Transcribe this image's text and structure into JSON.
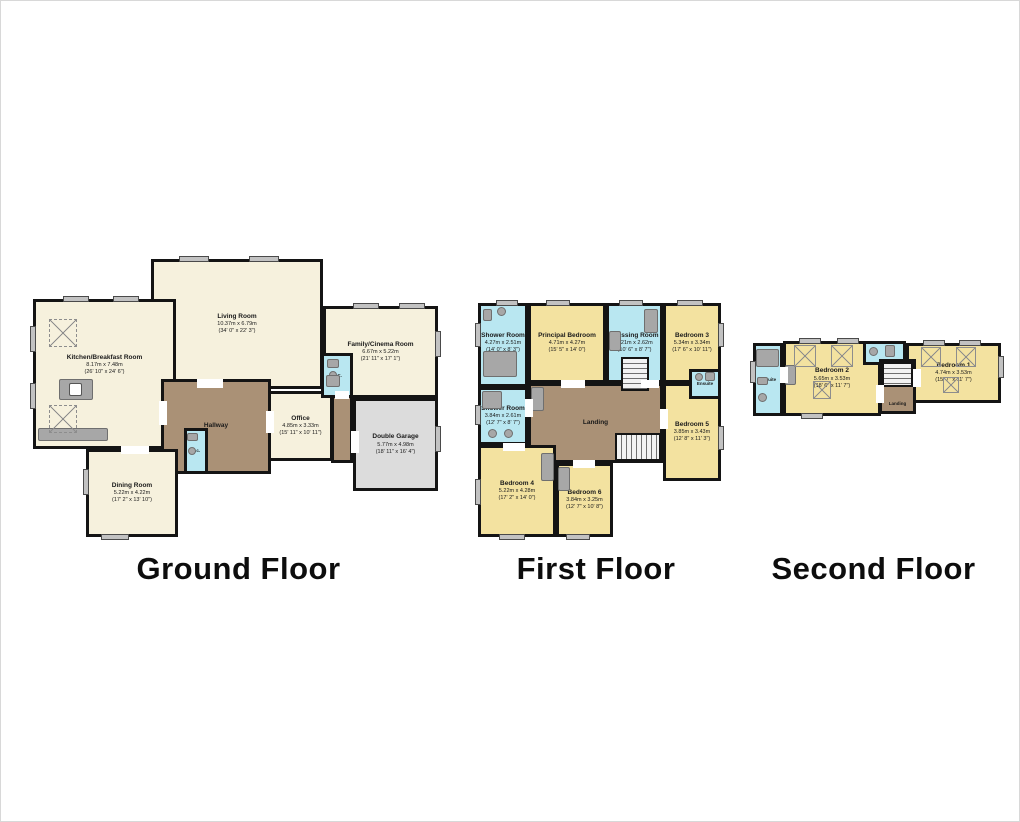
{
  "colors": {
    "wall": "#141414",
    "room_cream": "#f6f1dd",
    "bedroom_yellow": "#f3e2a0",
    "bathroom_blue": "#b9e7f1",
    "hall_brown": "#aa9176",
    "garage_grey": "#dcdcdc",
    "window_grey": "#c2c2c2"
  },
  "floors": [
    {
      "title": "Ground Floor",
      "rooms": [
        {
          "name": "Kitchen/Breakfast Room",
          "metric": "8.17m x 7.48m",
          "imperial": "(26' 10\" x 24' 6\")"
        },
        {
          "name": "Living Room",
          "metric": "10.37m x 6.79m",
          "imperial": "(34' 0\" x 22' 3\")"
        },
        {
          "name": "Family/Cinema Room",
          "metric": "6.67m x 5.22m",
          "imperial": "(21' 11\" x 17' 1\")"
        },
        {
          "name": "W.C.",
          "metric": "",
          "imperial": ""
        },
        {
          "name": "Hallway",
          "metric": "",
          "imperial": ""
        },
        {
          "name": "Office",
          "metric": "4.85m x 3.33m",
          "imperial": "(15' 11\" x 10' 11\")"
        },
        {
          "name": "Double Garage",
          "metric": "5.77m x 4.98m",
          "imperial": "(18' 11\" x 16' 4\")"
        },
        {
          "name": "Dining Room",
          "metric": "5.22m x 4.22m",
          "imperial": "(17' 2\" x 13' 10\")"
        },
        {
          "name": "w.c.",
          "metric": "",
          "imperial": ""
        }
      ]
    },
    {
      "title": "First Floor",
      "rooms": [
        {
          "name": "Shower Room",
          "metric": "4.27m x 2.51m",
          "imperial": "(14' 0\" x 8' 3\")"
        },
        {
          "name": "Principal Bedroom",
          "metric": "4.71m x 4.27m",
          "imperial": "(15' 5\" x 14' 0\")"
        },
        {
          "name": "Dressing Room",
          "metric": "3.21m x 2.62m",
          "imperial": "(10' 6\" x 8' 7\")"
        },
        {
          "name": "Bedroom 3",
          "metric": "5.34m x 3.34m",
          "imperial": "(17' 6\" x 10' 11\")"
        },
        {
          "name": "Shower Room",
          "metric": "3.84m x 2.61m",
          "imperial": "(12' 7\" x 8' 7\")"
        },
        {
          "name": "Landing",
          "metric": "",
          "imperial": ""
        },
        {
          "name": "Ensuite",
          "metric": "",
          "imperial": ""
        },
        {
          "name": "Bedroom 5",
          "metric": "3.85m x 3.43m",
          "imperial": "(12' 8\" x 11' 3\")"
        },
        {
          "name": "Bedroom 4",
          "metric": "5.22m x 4.28m",
          "imperial": "(17' 2\" x 14' 0\")"
        },
        {
          "name": "Bedroom 6",
          "metric": "3.84m x 3.25m",
          "imperial": "(12' 7\" x 10' 8\")"
        }
      ]
    },
    {
      "title": "Second Floor",
      "rooms": [
        {
          "name": "Ensuite",
          "metric": "",
          "imperial": ""
        },
        {
          "name": "Bedroom 2",
          "metric": "5.65m x 3.53m",
          "imperial": "(18' 6\" x 11' 7\")"
        },
        {
          "name": "W.C.",
          "metric": "",
          "imperial": ""
        },
        {
          "name": "Landing",
          "metric": "",
          "imperial": ""
        },
        {
          "name": "Bedroom 1",
          "metric": "4.74m x 3.53m",
          "imperial": "(15' 7\" x 11' 7\")"
        }
      ]
    }
  ]
}
